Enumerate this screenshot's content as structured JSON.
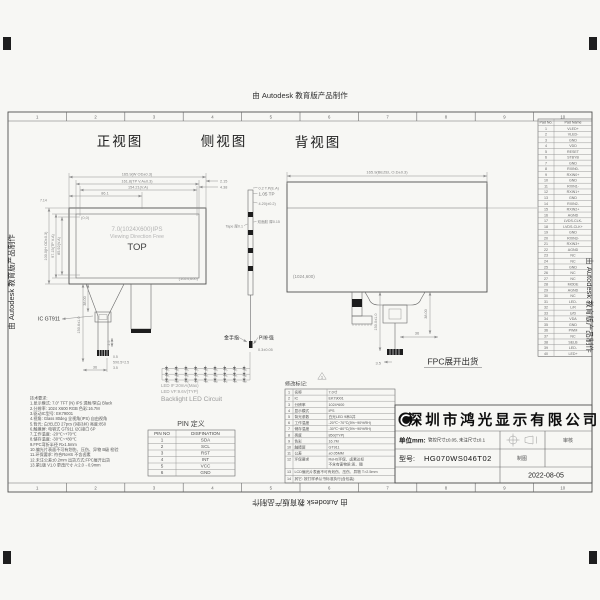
{
  "watermark": {
    "text": "由 Autodesk 教育版产品制作"
  },
  "ruler_numbers": [
    "1",
    "2",
    "3",
    "4",
    "5",
    "6",
    "7",
    "8",
    "9",
    "10"
  ],
  "view_labels": {
    "front": "正视图",
    "side": "侧视图",
    "back": "背视图"
  },
  "front_view": {
    "origin": "(0,0)",
    "corner": "(1024,600)",
    "center1": "7.0(1024X600)IPS",
    "center2": "Viewing Direction Free",
    "center3": "TOP",
    "dims": {
      "top1": "165.9(W OD±0.3)",
      "top2": "161.8(TP V.A±0.3)",
      "top3": "154.21(V.A)",
      "top4": "86.1",
      "right1": "2.15",
      "right2": "4.38",
      "left1": "100.0(H OD±0.3)",
      "left2": "97.15(TP V.A)",
      "left3": "85.92(V.A)",
      "left4": "7.14",
      "fpc_len": "150.6±1.0",
      "fpc_w": "38.00",
      "d25": "2.5",
      "d05": "0.5",
      "dpitch": "5X0.5=2.5",
      "d35": "3.5",
      "d36": "36"
    },
    "ic_label": "IC GT911"
  },
  "side_view": {
    "dim1": "0.2 T.P(E.A)",
    "dim2": "1.05 TP",
    "dim3": "4.20(±0.2)",
    "tape_label": "Tape 厚0.1",
    "adhesive_label": "双面胶 厚0.15",
    "gold_finger": "金手指",
    "stiffener": "PI补强",
    "tip_dim": "0.3±0.05"
  },
  "back_view": {
    "dim_top": "165.9(BEZEL O.D±0.3)",
    "corner": "(1024,600)",
    "fpc_len": "150.0±1.0",
    "fpc_w": "38.00",
    "d36": "36",
    "d35": "3.5",
    "ship_note": "FPC展开出货"
  },
  "led_circuit": {
    "rows": 3,
    "cols": 9,
    "if_line": "LED IF:20mA(Max)",
    "vf_line": "LED VF:9.6V(TYP)",
    "title": "Backlight LED Circuit"
  },
  "notes": [
    "技术要求:",
    "1.显示模式: 7.0\" TFT (N) IPS 透射/常白 Black",
    "2.分辨率: 1024 X600 RGB 色彩:16.7M",
    "3.驱动IC型号: EK79001",
    "4.视角: Glass 80deg 全视角(IPS) 自由视角",
    "5.背光: 白光LED 27pcs (9串3并) 亮度:850",
    "6.触摸屏: 电容式 GT911 I2C接口 6P",
    "7.工作温度: -20℃~+70℃",
    "8.储存温度: -30℃~+80℃",
    "9.FPC弯折半径 R≥1.5mm",
    "10.偏光片表面不可有划伤、压伤、异物 B级 检验",
    "11.环保要求: 符合RoHS 不含卤素",
    "12.未注公差±0.2mm 出货方式:FPC展开出货",
    "13.第1版 V1.0 更改尺寸 A:2.0→0.9mm"
  ],
  "pin_table": {
    "title": "PIN 定义",
    "headers": [
      "PIN NO",
      "DISFINATION"
    ],
    "rows": [
      [
        "1",
        "SDA"
      ],
      [
        "2",
        "SCL"
      ],
      [
        "3",
        "RST"
      ],
      [
        "4",
        "INT"
      ],
      [
        "5",
        "VCC"
      ],
      [
        "6",
        "GND"
      ]
    ]
  },
  "pad_table": {
    "headers": [
      "Pad No.",
      "Pad Name"
    ],
    "rows": [
      [
        "1",
        "VLED+"
      ],
      [
        "2",
        "VLED-"
      ],
      [
        "3",
        "GND"
      ],
      [
        "4",
        "VDD"
      ],
      [
        "5",
        "RESET"
      ],
      [
        "6",
        "STBYB"
      ],
      [
        "7",
        "GND"
      ],
      [
        "8",
        "RXIN0-"
      ],
      [
        "9",
        "RXIN0+"
      ],
      [
        "10",
        "GND"
      ],
      [
        "11",
        "RXIN1-"
      ],
      [
        "12",
        "RXIN1+"
      ],
      [
        "13",
        "GND"
      ],
      [
        "14",
        "RXIN2-"
      ],
      [
        "15",
        "RXIN2+"
      ],
      [
        "16",
        "AGND"
      ],
      [
        "17",
        "LVDS-CLK-"
      ],
      [
        "18",
        "LVDS-CLK+"
      ],
      [
        "19",
        "GND"
      ],
      [
        "20",
        "RXIN3-"
      ],
      [
        "21",
        "RXIN3+"
      ],
      [
        "22",
        "AGND"
      ],
      [
        "23",
        "NC"
      ],
      [
        "24",
        "NC"
      ],
      [
        "25",
        "GND"
      ],
      [
        "26",
        "NC"
      ],
      [
        "27",
        "NC"
      ],
      [
        "28",
        "MODE"
      ],
      [
        "29",
        "AGND"
      ],
      [
        "30",
        "NC"
      ],
      [
        "31",
        "LED-"
      ],
      [
        "32",
        "L/R"
      ],
      [
        "33",
        "U/D"
      ],
      [
        "34",
        "VDA"
      ],
      [
        "35",
        "GND"
      ],
      [
        "36",
        "PWM"
      ],
      [
        "37",
        "NC"
      ],
      [
        "38",
        "SELB"
      ],
      [
        "39",
        "LED-"
      ],
      [
        "40",
        "LED+"
      ]
    ]
  },
  "spec_table": {
    "rev_label": "修改标记:",
    "rev_no": "1",
    "rows": [
      [
        "1",
        "名称",
        "7.0寸"
      ],
      [
        "2",
        "IC",
        "EK79001"
      ],
      [
        "3",
        "分辨率",
        "1024*600"
      ],
      [
        "4",
        "显示模式",
        "IPS"
      ],
      [
        "5",
        "背光参数",
        "白光LED 9串3并"
      ],
      [
        "6",
        "工作温度",
        "-20℃~70℃(5%~90%RH)"
      ],
      [
        "7",
        "储存温度",
        "-30℃~80℃(5%~90%RH)"
      ],
      [
        "8",
        "亮度",
        "850(TYP)"
      ],
      [
        "9",
        "色彩",
        "16.7M"
      ],
      [
        "10",
        "触摸屏",
        "GT911"
      ],
      [
        "11",
        "公差",
        "±0.05MM"
      ],
      [
        "12",
        "环保要求",
        "RoHS环保、卤素达标\n不含有害物质:汞、镉"
      ],
      [
        "13",
        "",
        "LCD偏光片表面不可有划伤、压伤、异物 T>2.5mm"
      ],
      [
        "14",
        "",
        "其它: 按打样承认书标准执行(含包装)"
      ]
    ]
  },
  "title_block": {
    "company": "深圳市鸿光显示有限公司",
    "unit_label": "单位mm:",
    "unit_value": "管控尺寸±0.05, 未注尺寸±0.1",
    "model_label": "型号:",
    "model_value": "HG070WS046T02",
    "drawn_label": "制图",
    "check_label": "审核",
    "date": "2022-08-05"
  }
}
